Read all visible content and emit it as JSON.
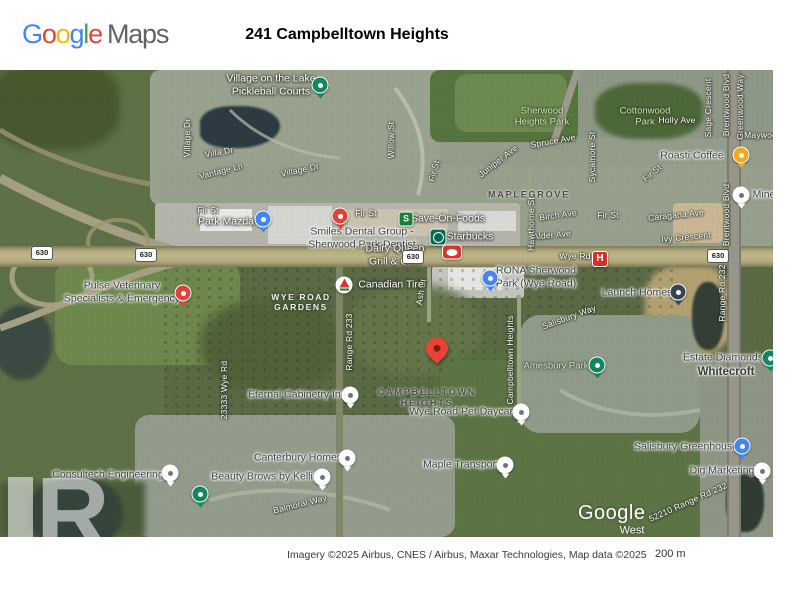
{
  "header": {
    "logo_google": "Google",
    "logo_maps": "Maps",
    "title": "241 Campbelltown Heights"
  },
  "attribution": {
    "imagery": "Imagery ©2025 Airbus, CNES / Airbus, Maxar Technologies, Map data ©2025",
    "scale": "200 m"
  },
  "colors": {
    "google_logo_letters": [
      "#4285F4",
      "#EA4335",
      "#FBBC05",
      "#4285F4",
      "#34A853",
      "#EA4335"
    ],
    "logo_maps_gray": "#5f6368",
    "destination_red": "#EA4335"
  },
  "map": {
    "watermark": "Google",
    "watermark_letter": "R",
    "shield_text": "630",
    "shields": [
      {
        "x": 42,
        "y": 183
      },
      {
        "x": 146,
        "y": 185
      },
      {
        "x": 413,
        "y": 187
      },
      {
        "x": 718,
        "y": 186
      }
    ],
    "marker_colors": {
      "red": "#DB4437",
      "blue": "#4285F4",
      "green": "#12875E",
      "dark": "#37474F",
      "orange": "#F5A623",
      "white": "#FFFFFF",
      "dest": "#EA4335"
    },
    "labels": [
      {
        "text": "Village Dr",
        "x": 187,
        "y": 68,
        "k": "st",
        "r": -90
      },
      {
        "text": "Villa Dr",
        "x": 219,
        "y": 82,
        "k": "st",
        "r": -10
      },
      {
        "text": "Vantage Ln",
        "x": 221,
        "y": 101,
        "k": "st",
        "r": -14
      },
      {
        "text": "Village Dr",
        "x": 300,
        "y": 100,
        "k": "st",
        "r": -12
      },
      {
        "text": "Willow St",
        "x": 391,
        "y": 70,
        "k": "st",
        "r": -90
      },
      {
        "text": "Fir St",
        "x": 208,
        "y": 140,
        "k": "st"
      },
      {
        "text": "Fir St",
        "x": 366,
        "y": 143,
        "k": "st"
      },
      {
        "text": "Fir St",
        "x": 608,
        "y": 145,
        "k": "st"
      },
      {
        "text": "Fir St",
        "x": 434,
        "y": 101,
        "k": "st",
        "r": -75
      },
      {
        "text": "Fir St",
        "x": 652,
        "y": 103,
        "k": "st",
        "r": -40
      },
      {
        "text": "Spruce Ave",
        "x": 553,
        "y": 71,
        "k": "st",
        "r": -10
      },
      {
        "text": "Sycamore St",
        "x": 592,
        "y": 87,
        "k": "st",
        "r": -90
      },
      {
        "text": "Juniper Ave",
        "x": 498,
        "y": 91,
        "k": "st",
        "r": -38
      },
      {
        "text": "Holly Ave",
        "x": 677,
        "y": 50,
        "k": "st"
      },
      {
        "text": "Sage Crescent",
        "x": 708,
        "y": 38,
        "k": "st",
        "r": -90
      },
      {
        "text": "Brentwood Blvd",
        "x": 726,
        "y": 35,
        "k": "st",
        "r": -90
      },
      {
        "text": "Greenwood Way",
        "x": 740,
        "y": 37,
        "k": "st",
        "r": -90
      },
      {
        "text": "Maywood",
        "x": 763,
        "y": 65,
        "k": "st"
      },
      {
        "text": "Brentwood Blvd",
        "x": 726,
        "y": 145,
        "k": "st",
        "r": -90
      },
      {
        "text": "Birch Ave",
        "x": 558,
        "y": 145,
        "k": "st",
        "r": -8
      },
      {
        "text": "Alder Ave",
        "x": 552,
        "y": 165,
        "k": "st",
        "r": -5
      },
      {
        "text": "Hawthorne St",
        "x": 531,
        "y": 154,
        "k": "st",
        "r": -90
      },
      {
        "text": "Caragana Ave",
        "x": 676,
        "y": 145,
        "k": "st",
        "r": -6
      },
      {
        "text": "Ivy Crescent",
        "x": 686,
        "y": 167,
        "k": "st",
        "r": -5
      },
      {
        "text": "Wye Rd",
        "x": 575,
        "y": 186,
        "k": "st"
      },
      {
        "text": "Ash St",
        "x": 421,
        "y": 222,
        "k": "st",
        "r": -80
      },
      {
        "text": "Range Rd 233",
        "x": 349,
        "y": 272,
        "k": "st",
        "r": -90
      },
      {
        "text": "23333 Wye Rd",
        "x": 224,
        "y": 320,
        "k": "st",
        "r": -90
      },
      {
        "text": "Campbelltown Heights",
        "x": 510,
        "y": 290,
        "k": "st",
        "r": -90
      },
      {
        "text": "Salisbury Way",
        "x": 569,
        "y": 247,
        "k": "st",
        "r": -20
      },
      {
        "text": "Range Rd 232",
        "x": 722,
        "y": 223,
        "k": "st",
        "r": -90
      },
      {
        "text": "Balmoral Way",
        "x": 300,
        "y": 434,
        "k": "st",
        "r": -14
      },
      {
        "text": "52210 Range Rd 232",
        "x": 688,
        "y": 432,
        "k": "st",
        "r": -24
      },
      {
        "text": "MAPLEGROVE",
        "x": 529,
        "y": 125,
        "k": "hd"
      },
      {
        "lines": [
          "WYE ROAD",
          "GARDENS"
        ],
        "x": 301,
        "y": 232,
        "k": "hw"
      },
      {
        "lines": [
          "CAMPBELLTOWN",
          "HEIGHTS"
        ],
        "x": 427,
        "y": 328,
        "k": "hd"
      },
      {
        "text": "Whitecroft",
        "x": 726,
        "y": 303,
        "k": "loc"
      },
      {
        "text": "West",
        "x": 632,
        "y": 461,
        "k": "wmS"
      },
      {
        "lines": [
          "Sherwood",
          "Heights Park"
        ],
        "x": 542,
        "y": 47,
        "k": "pk"
      },
      {
        "lines": [
          "Cottonwood",
          "Park"
        ],
        "x": 645,
        "y": 47,
        "k": "pk"
      },
      {
        "text": "Amesbury Park",
        "x": 556,
        "y": 296,
        "k": "pk"
      },
      {
        "lines": [
          "Village on the Lake",
          "Pickleball Courts"
        ],
        "x": 271,
        "y": 15,
        "k": "pw"
      },
      {
        "text": "Park Mazda",
        "x": 226,
        "y": 152,
        "k": "pw"
      },
      {
        "lines": [
          "Smiles Dental Group -",
          "Sherwood Park Dentist"
        ],
        "x": 362,
        "y": 168,
        "k": "pd"
      },
      {
        "text": "Save-On-Foods",
        "x": 448,
        "y": 149,
        "k": "pw"
      },
      {
        "text": "Starbucks",
        "x": 470,
        "y": 167,
        "k": "pw"
      },
      {
        "lines": [
          "Dairy Queen",
          "Grill & Chill"
        ],
        "x": 395,
        "y": 185,
        "k": "pw"
      },
      {
        "text": "Canadian Tire",
        "x": 391,
        "y": 215,
        "k": "pw"
      },
      {
        "lines": [
          "RONA Sherwood",
          "Park (Wye Road)"
        ],
        "x": 536,
        "y": 207,
        "k": "pd"
      },
      {
        "text": "Launch Homes",
        "x": 637,
        "y": 223,
        "k": "pd"
      },
      {
        "lines": [
          "Pulse Veterinary",
          "Specialists & Emergency"
        ],
        "x": 122,
        "y": 222,
        "k": "pd"
      },
      {
        "text": "Estate Diamonds",
        "x": 723,
        "y": 288,
        "k": "pd"
      },
      {
        "text": "Eternal Cabinetry Inc",
        "x": 297,
        "y": 325,
        "k": "pd"
      },
      {
        "text": "Wye Road Pet Daycare",
        "x": 464,
        "y": 342,
        "k": "pd"
      },
      {
        "text": "Maple Transport",
        "x": 461,
        "y": 395,
        "k": "pd"
      },
      {
        "text": "Salisbury Greenhouse",
        "x": 686,
        "y": 377,
        "k": "pd"
      },
      {
        "text": "Dig Marketing",
        "x": 722,
        "y": 401,
        "k": "pd"
      },
      {
        "text": "Canterbury Homes",
        "x": 298,
        "y": 388,
        "k": "pd"
      },
      {
        "text": "Beauty Brows by Kellie",
        "x": 265,
        "y": 407,
        "k": "pd"
      },
      {
        "text": "Consultech Engineering",
        "x": 108,
        "y": 405,
        "k": "pd"
      },
      {
        "text": "Roasti Coffee",
        "x": 692,
        "y": 86,
        "k": "pd"
      },
      {
        "text": "Mine",
        "x": 764,
        "y": 125,
        "k": "pd"
      }
    ],
    "markers": [
      {
        "t": "green",
        "x": 320,
        "y": 15,
        "name": "pickleball-courts"
      },
      {
        "t": "blue",
        "x": 263,
        "y": 149,
        "name": "park-mazda"
      },
      {
        "t": "red",
        "x": 340,
        "y": 146,
        "name": "smiles-dental"
      },
      {
        "t": "saveon",
        "x": 406,
        "y": 149,
        "name": "save-on-foods"
      },
      {
        "t": "starbucks",
        "x": 438,
        "y": 167,
        "name": "starbucks"
      },
      {
        "t": "dq",
        "x": 452,
        "y": 182,
        "name": "dairy-queen"
      },
      {
        "t": "hospital",
        "x": 600,
        "y": 189,
        "name": "hospital"
      },
      {
        "t": "cantire",
        "x": 344,
        "y": 215,
        "name": "canadian-tire"
      },
      {
        "t": "blue",
        "x": 490,
        "y": 208,
        "name": "rona"
      },
      {
        "t": "dark",
        "x": 678,
        "y": 222,
        "name": "launch-homes"
      },
      {
        "t": "red",
        "x": 183,
        "y": 223,
        "name": "pulse-veterinary"
      },
      {
        "t": "green",
        "x": 770,
        "y": 288,
        "name": "estate-diamonds"
      },
      {
        "t": "green",
        "x": 597,
        "y": 295,
        "name": "amesbury-park"
      },
      {
        "t": "green",
        "x": 200,
        "y": 424,
        "name": "park"
      },
      {
        "t": "white",
        "x": 350,
        "y": 325,
        "name": "eternal-cabinetry"
      },
      {
        "t": "white",
        "x": 521,
        "y": 342,
        "name": "wye-road-pet-daycare"
      },
      {
        "t": "white",
        "x": 505,
        "y": 395,
        "name": "maple-transport"
      },
      {
        "t": "blue",
        "x": 742,
        "y": 376,
        "name": "salisbury-greenhouse"
      },
      {
        "t": "white",
        "x": 762,
        "y": 401,
        "name": "dig-marketing"
      },
      {
        "t": "white",
        "x": 347,
        "y": 388,
        "name": "canterbury-homes"
      },
      {
        "t": "white",
        "x": 322,
        "y": 407,
        "name": "beauty-brows"
      },
      {
        "t": "white",
        "x": 170,
        "y": 403,
        "name": "consultech-engineering"
      },
      {
        "t": "orange",
        "x": 741,
        "y": 85,
        "name": "roasti-coffee"
      },
      {
        "t": "white",
        "x": 741,
        "y": 125,
        "name": "mine"
      },
      {
        "t": "dest",
        "x": 437,
        "y": 288,
        "name": "destination-241-campbelltown-heights"
      }
    ]
  }
}
